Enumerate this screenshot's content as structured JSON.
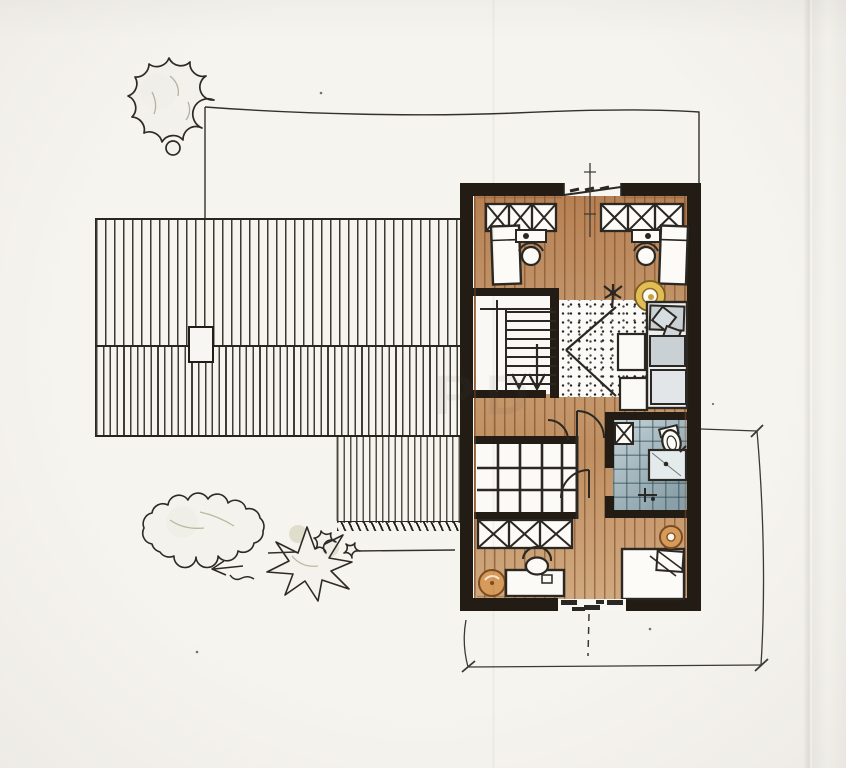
{
  "meta": {
    "description": "Hand-drawn architectural floor plan sketch of an attic storey with adjoining roof plan, garden shrubs and dimension lines",
    "style": "ink and colored pencil on folded white paper"
  },
  "colors": {
    "paper": "#f6f4ef",
    "ink": "#2b2722",
    "wall": "#221c15",
    "wood": "#c79a6c",
    "wood_dark": "#8a5a33",
    "tile": "#a7bac0",
    "tile_line": "#52707c",
    "sofa": "#c9d1d5",
    "sofa_light": "#e2e6e8",
    "accent_yellow": "#e2bd55",
    "accent_orange": "#d69a5b",
    "foliage": "#a8ad7e",
    "dimension": "#3b3935",
    "watermark_color": "#5a5a5a"
  },
  "watermark": "PD",
  "site": {
    "boundary": "property boundary line with corner at tree",
    "tree": "deciduous tree at north-west boundary corner",
    "bushes": [
      "large scalloped shrub",
      "spiky shrub",
      "two small shrubs"
    ],
    "ground_line": "terrace edge line"
  },
  "roof": {
    "upper_band": "hatched roof slope, wide line spacing",
    "lower_band": "hatched roof slope, dense line spacing",
    "extension": "lower roof section with eaves tick marks",
    "chimney": "white chimney opening in roof"
  },
  "floor_plan": {
    "rooms": [
      {
        "id": "bedroom-north",
        "features": [
          "wardrobe row with X symbols left",
          "wardrobe row with X symbols right",
          "ridge window with glazing dashes",
          "bed left",
          "bed right",
          "desk and chair left",
          "desk and chair right",
          "yellow hanging chair",
          "plant"
        ]
      },
      {
        "id": "stairwell",
        "features": [
          "nine stair treads",
          "handrail",
          "two down arrows"
        ]
      },
      {
        "id": "open-landing",
        "features": [
          "dotted rug",
          "sight-line chevron",
          "two coffee tables",
          "sofa with grey cushions and pillows"
        ]
      },
      {
        "id": "bathroom",
        "features": [
          "blue tiled floor",
          "toilet",
          "shower tray with drain",
          "basin fittings",
          "small cabinet with X"
        ]
      },
      {
        "id": "glazed-void",
        "features": [
          "glazing grid 4 x 3"
        ]
      },
      {
        "id": "bedroom-south",
        "features": [
          "wardrobe row with X symbols",
          "desk",
          "round-back chair",
          "orange stool",
          "bed with folded blanket",
          "orange bedside lamp",
          "balcony door with stepped threshold"
        ]
      }
    ],
    "dimension_lines": [
      "overall width dimension below plan",
      "depth dimension right of plan",
      "dashed centre axis south",
      "centre axis line north"
    ]
  }
}
